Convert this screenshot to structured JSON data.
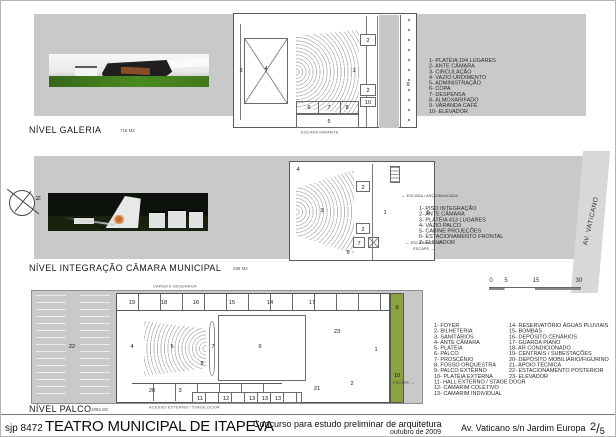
{
  "titlebar": {
    "code": "sjp 8472",
    "title": "TEATRO MUNICIPAL DE ITAPEVA",
    "subtitle": "Concurso para estudo preliminar de arquitetura",
    "date": "outubro de 2009",
    "address": "Av. Vaticano s/n Jardim Europa",
    "sheet_num": "2",
    "sheet_sep": "/",
    "sheet_total": "5"
  },
  "icons": {
    "arrow_left": "←",
    "arrow_right": "→"
  },
  "galeria": {
    "label": "NÍVEL GALERIA",
    "area": "716 M2",
    "caption": "ESCADA MIRANTE",
    "legend": [
      "1- PLATÉIA 194 LUGARES",
      "2- ANTE CÂMARA",
      "3- CIRCULAÇÃO",
      "4- VAZIO URDIMENTO",
      "5- ADMINISTRAÇÃO",
      "6- COPA",
      "7- DESPENSA",
      "8- ALMOXARIFADO",
      "9- VARANDA CAFÉ",
      "10- ELEVADOR"
    ],
    "numbers": [
      "3",
      "4",
      "1",
      "2",
      "2",
      "10",
      "6",
      "7",
      "8",
      "5",
      "9"
    ]
  },
  "integracao": {
    "label": "NÍVEL INTEGRAÇÃO CÂMARA MUNICIPAL",
    "area": "288 M2",
    "street": "AV. VATICANO",
    "compass_n": "N",
    "label_arquibancada": "ESCADA / ARQUIBANCADA",
    "label_foyer_line1": "ESCADA FOYER",
    "label_foyer_line2": "ESCAPE",
    "legend": [
      "1- PISO INTEGRAÇÃO",
      "2- ANTE CÂMARA",
      "3- PLATÉIA 413 LUGARES",
      "4- VAZIO PALCO",
      "5- CABINE PROJEÇÕES",
      "6- ESTACIONAMENTO FRONTAL",
      "7- ELEVADOR"
    ],
    "numbers": [
      "4",
      "3",
      "2",
      "2",
      "5",
      "7",
      "1",
      "6"
    ]
  },
  "palco": {
    "label": "NÍVEL PALCO",
    "area": "1855 M2",
    "caption_top": "CARGA E DESCARGA",
    "caption_bottom": "ACESSO EXTERNO / STAGE DOOR",
    "label_escape": "ESCAPE",
    "legend_col1": [
      "1- FOYER",
      "2- BILHETERIA",
      "3- SANITÁRIOS",
      "4- ANTE CÂMARA",
      "5- PLATÉIA",
      "6- PALCO",
      "7- PROSCÊNIO",
      "8- FOSSO ORQUESTRA",
      "9- PALCO EXTERNO",
      "10- PLATÉIA EXTERNA",
      "11- HALL EXTERNO / STAGE DOOR",
      "12- CAMARIM COLETIVO",
      "13- CAMARIM INDIVIDUAL"
    ],
    "legend_col2": [
      "14- RESERVATÓRIO ÁGUAS PLUVIAIS",
      "15- BOMBAS",
      "16- DEPÓSITO CENÁRIOS",
      "17- GUARDA PIANO",
      "18- AR CONDICIONADO",
      "19- CENTRAIS / SUBESTAÇÕES",
      "20- DEPÓSITO MOBILIÁRIO/FIGURINO",
      "21- APOIO TÉCNICA",
      "22- ESTACIONAMENTO POSTERIOR",
      "23- ELEVADOR"
    ],
    "numbers": [
      "22",
      "19",
      "18",
      "16",
      "15",
      "14",
      "17",
      "4",
      "5",
      "7",
      "6",
      "8",
      "20",
      "3",
      "21",
      "11",
      "12",
      "13",
      "13",
      "13",
      "23",
      "2",
      "1",
      "9",
      "10"
    ]
  },
  "scalebar": {
    "t0": "0",
    "t1": "5",
    "t2": "15",
    "t3": "30"
  },
  "colors": {
    "panel": "#c9c9c9",
    "green_strip": "#8ca23e",
    "accent_orange": "#c96a1c"
  }
}
